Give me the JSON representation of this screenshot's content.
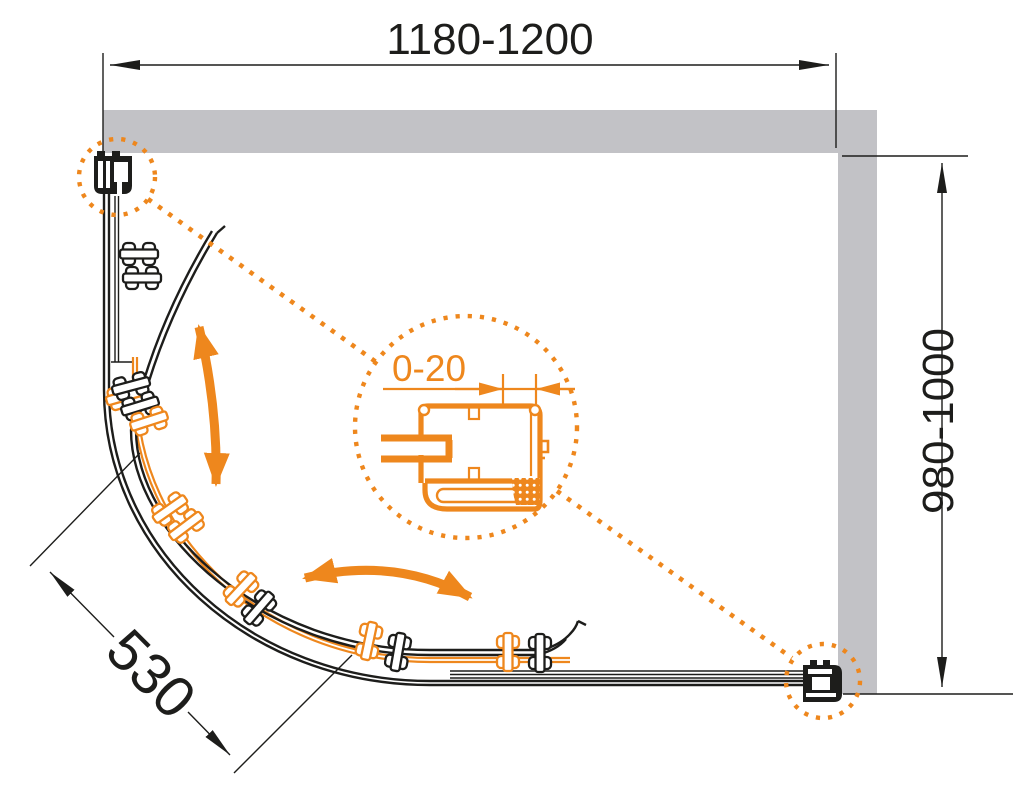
{
  "dimensions": {
    "width": "1180-1200",
    "depth": "980-1000",
    "door_radius": "530",
    "wall_adjustment": "0-20"
  },
  "colors": {
    "accent": "#EE871D",
    "wall": "#C2C2C6",
    "line": "#1D1D1B",
    "background": "#FFFFFF"
  }
}
